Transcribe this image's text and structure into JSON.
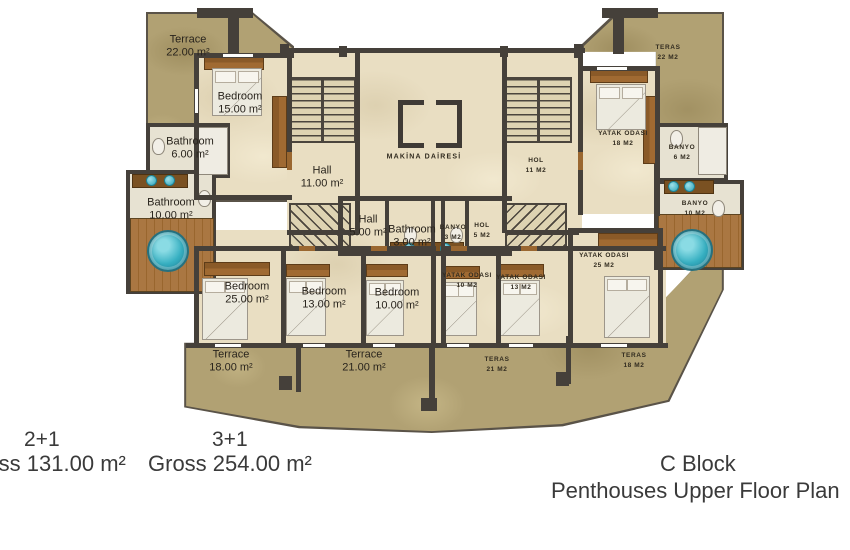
{
  "plan": {
    "left_unit": {
      "rooms": [
        {
          "name": "Terrace",
          "area": "22.00 m²"
        },
        {
          "name": "Bedroom",
          "area": "15.00 m²"
        },
        {
          "name": "Bathroom",
          "area": "6.00 m²"
        },
        {
          "name": "Bathroom",
          "area": "10.00 m²"
        },
        {
          "name": "Hall",
          "area": "11.00 m²"
        },
        {
          "name": "Hall",
          "area": "5.00 m²"
        },
        {
          "name": "Bathroom",
          "area": "3.00 m²"
        },
        {
          "name": "Bedroom",
          "area": "25.00 m²"
        },
        {
          "name": "Bedroom",
          "area": "13.00 m²"
        },
        {
          "name": "Bedroom",
          "area": "10.00 m²"
        },
        {
          "name": "Terrace",
          "area": "18.00 m²"
        },
        {
          "name": "Terrace",
          "area": "21.00 m²"
        }
      ]
    },
    "right_unit": {
      "rooms": [
        {
          "name": "TERAS",
          "area": "22 M2"
        },
        {
          "name": "YATAK ODASI",
          "area": "18 M2"
        },
        {
          "name": "BANYO",
          "area": "6 M2"
        },
        {
          "name": "BANYO",
          "area": "10 M2"
        },
        {
          "name": "HOL",
          "area": "11 M2"
        },
        {
          "name": "HOL",
          "area": "5 M2"
        },
        {
          "name": "BANYO",
          "area": "3 M2"
        },
        {
          "name": "YATAK ODASI",
          "area": "10 M2"
        },
        {
          "name": "YATAK ODASI",
          "area": "13 M2"
        },
        {
          "name": "YATAK ODASI",
          "area": "25 M2"
        },
        {
          "name": "TERAS",
          "area": "21 M2"
        },
        {
          "name": "TERAS",
          "area": "18 M2"
        }
      ]
    },
    "center": {
      "machine_room": "MAKİNA DAİRESİ"
    }
  },
  "captions": {
    "unit_a_type": "2+1",
    "unit_a_gross": "Gross 131.00 m²",
    "unit_b_type": "3+1",
    "unit_b_gross": "Gross 254.00 m²",
    "block": "C Block",
    "plan_title": "Penthouses Upper Floor Plan"
  },
  "colors": {
    "wall": "#45403a",
    "floor": "#e9dec2",
    "terrace": "#b1a173",
    "wood_deck": "#a9743f",
    "jacuzzi": "#35b4c6",
    "bed": "#eceadf"
  }
}
